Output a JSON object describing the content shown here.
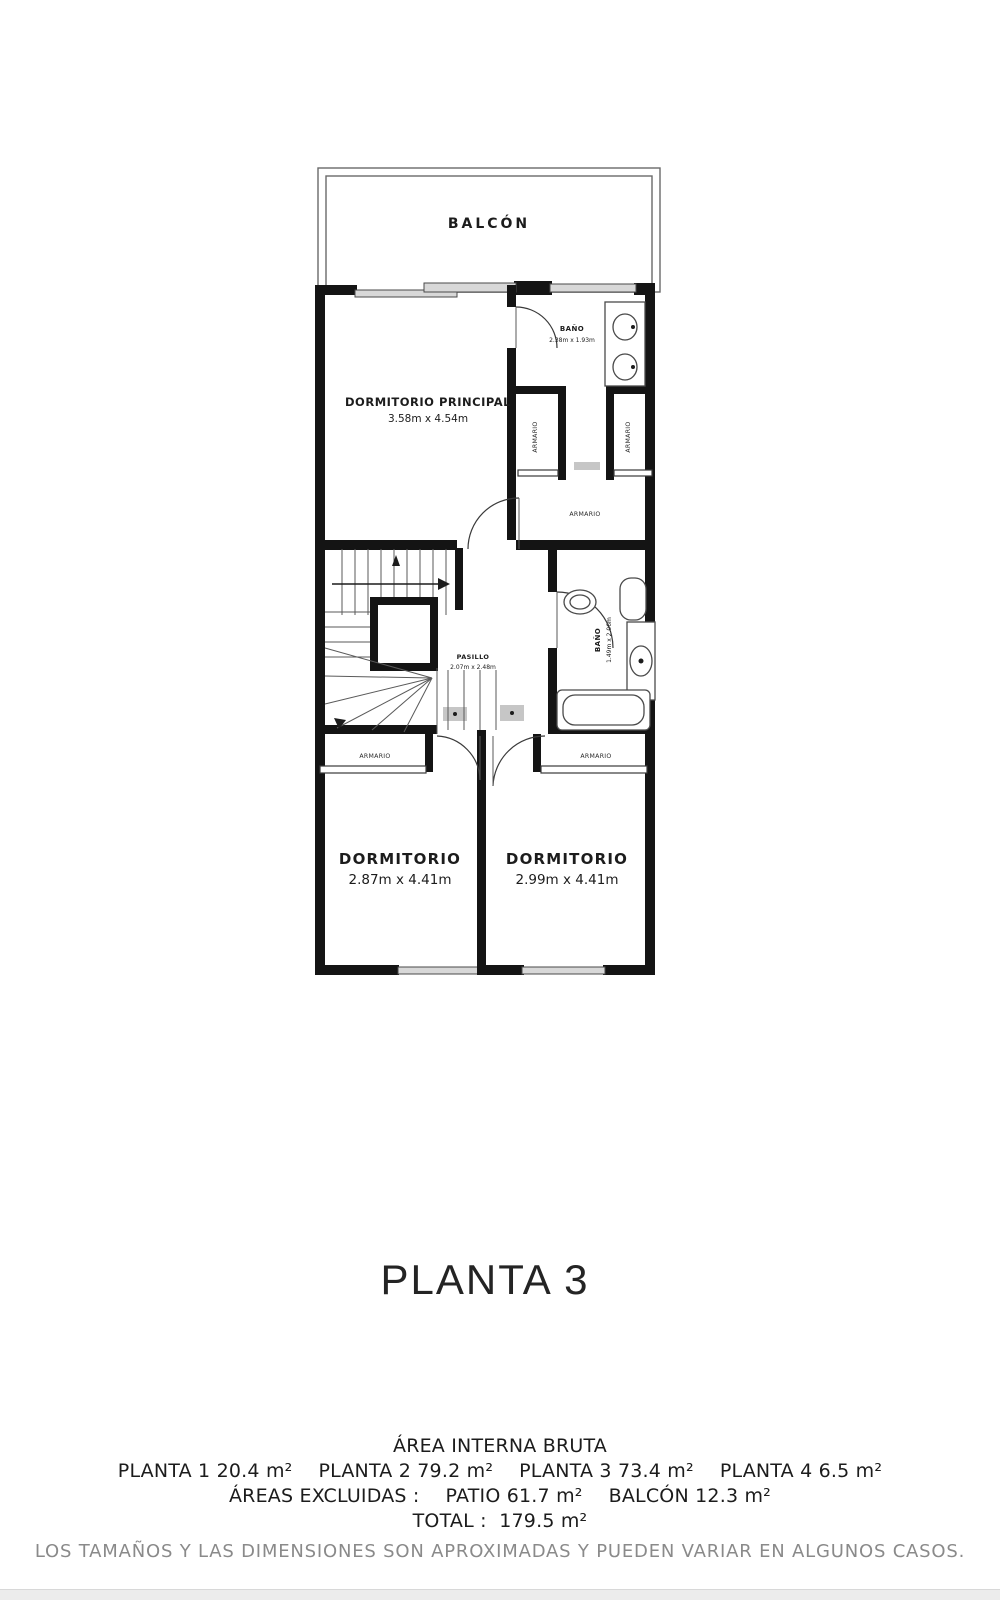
{
  "plan": {
    "balcony": {
      "label": "BALCÓN"
    },
    "master_bedroom": {
      "name": "DORMITORIO PRINCIPAL",
      "dims": "3.58m x 4.54m"
    },
    "bathroom_top": {
      "name": "BAÑO",
      "dims": "2.38m x 1.93m"
    },
    "bathroom_middle": {
      "name": "BAÑO",
      "dims": "1.49m x 2.06m"
    },
    "hallway": {
      "name": "PASILLO",
      "dims": "2.07m x 2.48m"
    },
    "bedroom_left": {
      "name": "DORMITORIO",
      "dims": "2.87m x 4.41m"
    },
    "bedroom_right": {
      "name": "DORMITORIO",
      "dims": "2.99m x 4.41m"
    },
    "closet_label": "ARMARIO"
  },
  "title": "PLANTA 3",
  "area_summary": {
    "heading": "ÁREA INTERNA BRUTA",
    "floors": [
      {
        "label": "PLANTA 1",
        "area": "20.4 m²"
      },
      {
        "label": "PLANTA 2",
        "area": "79.2 m²"
      },
      {
        "label": "PLANTA 3",
        "area": "73.4 m²"
      },
      {
        "label": "PLANTA 4",
        "area": "6.5 m²"
      }
    ],
    "excluded_label": "ÁREAS EXCLUIDAS :",
    "excluded": [
      {
        "label": "PATIO",
        "area": "61.7 m²"
      },
      {
        "label": "BALCÓN",
        "area": "12.3 m²"
      }
    ],
    "total_label": "TOTAL :",
    "total_area": "179.5 m²",
    "disclaimer": "LOS TAMAÑOS Y LAS DIMENSIONES SON APROXIMADAS Y PUEDEN VARIAR EN ALGUNOS CASOS."
  },
  "colors": {
    "wall": "#141414",
    "window_fill": "#d8d8d8",
    "text": "#1c1c1c",
    "muted": "#8a8a8a"
  }
}
